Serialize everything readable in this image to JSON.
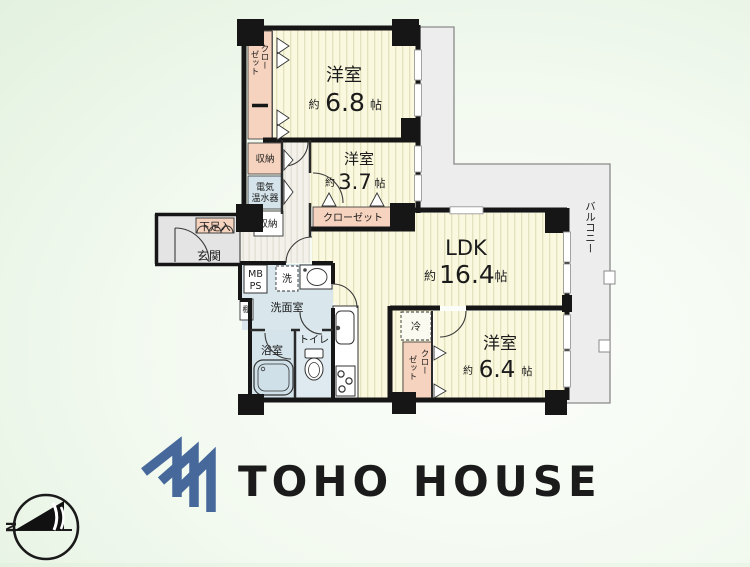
{
  "plan": {
    "rooms": {
      "west68": {
        "name": "洋室",
        "prefix": "約",
        "area": "6.8",
        "unit": "帖"
      },
      "west37": {
        "name": "洋室",
        "prefix": "約",
        "area": "3.7",
        "unit": "帖"
      },
      "ldk": {
        "name": "LDK",
        "prefix": "約",
        "area": "16.4",
        "unit": "帖"
      },
      "west64": {
        "name": "洋室",
        "prefix": "約",
        "area": "6.4",
        "unit": "帖"
      }
    },
    "labels": {
      "closet68_line1": "クロー",
      "closet68_line2": "ゼット",
      "closet37": "クローゼット",
      "closet64_line1": "クロー",
      "closet64_line2": "ゼット",
      "storage_top": "収納",
      "heater_line1": "電気",
      "heater_line2": "温水器",
      "storage_bottom": "収納",
      "shoebox": "下足入",
      "entrance": "玄関",
      "mb": "MB",
      "ps": "PS",
      "shelf": "棚",
      "washer": "洗",
      "washroom": "洗面室",
      "bath": "浴室",
      "toilet": "トイレ",
      "fridge": "冷",
      "balcony": "バルコニー"
    }
  },
  "branding": {
    "logo_text": "TOHO HOUSE"
  },
  "compass": {
    "north": "N"
  },
  "colors": {
    "logo_blue": "#46689A",
    "room_yellow": "#FAF8DE",
    "room_stripe": "#E4E1BE",
    "closet_pink": "#F6D3BE",
    "wet_area_blue": "#D9E7ED",
    "entry_gray": "#E4E4E4",
    "balcony_gray": "#ECEDEC",
    "wall_black": "#161616"
  }
}
